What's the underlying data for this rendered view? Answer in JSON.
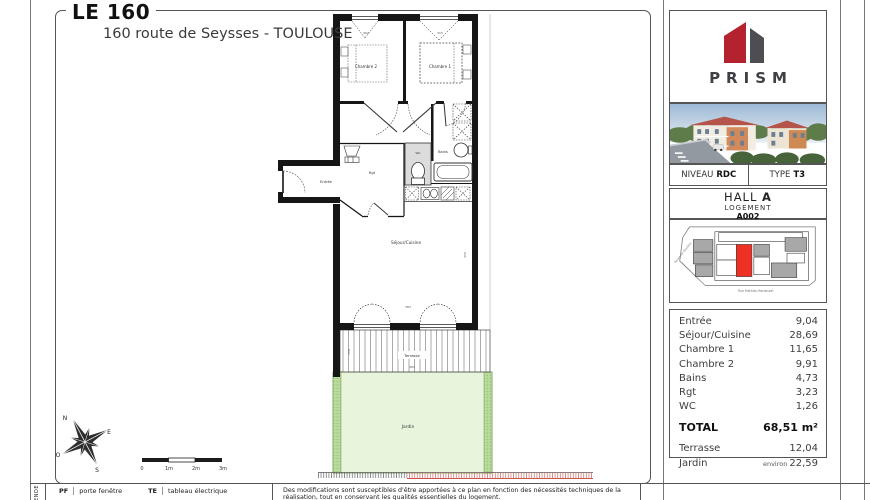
{
  "header": {
    "title": "LE 160",
    "subtitle": "160 route de Seysses - TOULOUSE"
  },
  "brand": {
    "name": "PRISM",
    "red": "#b5222f",
    "gray": "#4d4d52"
  },
  "unit_info": {
    "niveau_label": "NIVEAU",
    "niveau_value": "RDC",
    "type_label": "TYPE",
    "type_value": "T3",
    "hall_label": "HALL",
    "hall_value": "A",
    "logement_label": "LOGEMENT",
    "logement_value": "A002"
  },
  "site_plan": {
    "street_left": "Route de Seysses",
    "street_bottom": "Rue Mathieu Berdoulat",
    "unit_color": "#ee3124"
  },
  "areas": {
    "rows": [
      {
        "label": "Entrée",
        "value": "9,04"
      },
      {
        "label": "Séjour/Cuisine",
        "value": "28,69"
      },
      {
        "label": "Chambre 1",
        "value": "11,65"
      },
      {
        "label": "Chambre 2",
        "value": "9,91"
      },
      {
        "label": "Bains",
        "value": "4,73"
      },
      {
        "label": "Rgt",
        "value": "3,23"
      },
      {
        "label": "WC",
        "value": "1,26"
      }
    ],
    "total_label": "TOTAL",
    "total_value": "68,51 m²",
    "outdoor_rows": [
      {
        "label": "Terrasse",
        "prefix": "",
        "value": "12,04"
      },
      {
        "label": "Jardin",
        "prefix": "environ",
        "value": "22,59"
      }
    ]
  },
  "plan": {
    "rooms": {
      "chambre2": "Chambre 2",
      "chambre1": "Chambre 1",
      "entree": "Entrée",
      "rgt": "Rgt",
      "wc": "WC",
      "bains": "Bains",
      "sejour": "Séjour/Cuisine",
      "terrasse": "Terrasse",
      "jardin": "Jardin"
    },
    "dims": {
      "top_left": "362",
      "top_right": "315",
      "right": "450",
      "bottom": "383",
      "terrace_w": "384",
      "terrace_h": "150"
    },
    "garden_green": "#e9f4dc",
    "garden_strip": "#b9da9c"
  },
  "compass": {
    "n": "N",
    "e": "E",
    "s": "S",
    "o": "O"
  },
  "scale_bar": {
    "ticks": [
      "0",
      "1m",
      "2m",
      "3m"
    ]
  },
  "legend": {
    "side_label": "LÉGENDE",
    "items": [
      {
        "abbr": "PF",
        "label": "porte fenêtre"
      },
      {
        "abbr": "TE",
        "label": "tableau électrique"
      }
    ]
  },
  "disclaimer": "Des modifications sont susceptibles d'être apportées à ce plan en fonction des nécessités techniques de la réalisation, tout en conservant les qualités essentielles du logement."
}
